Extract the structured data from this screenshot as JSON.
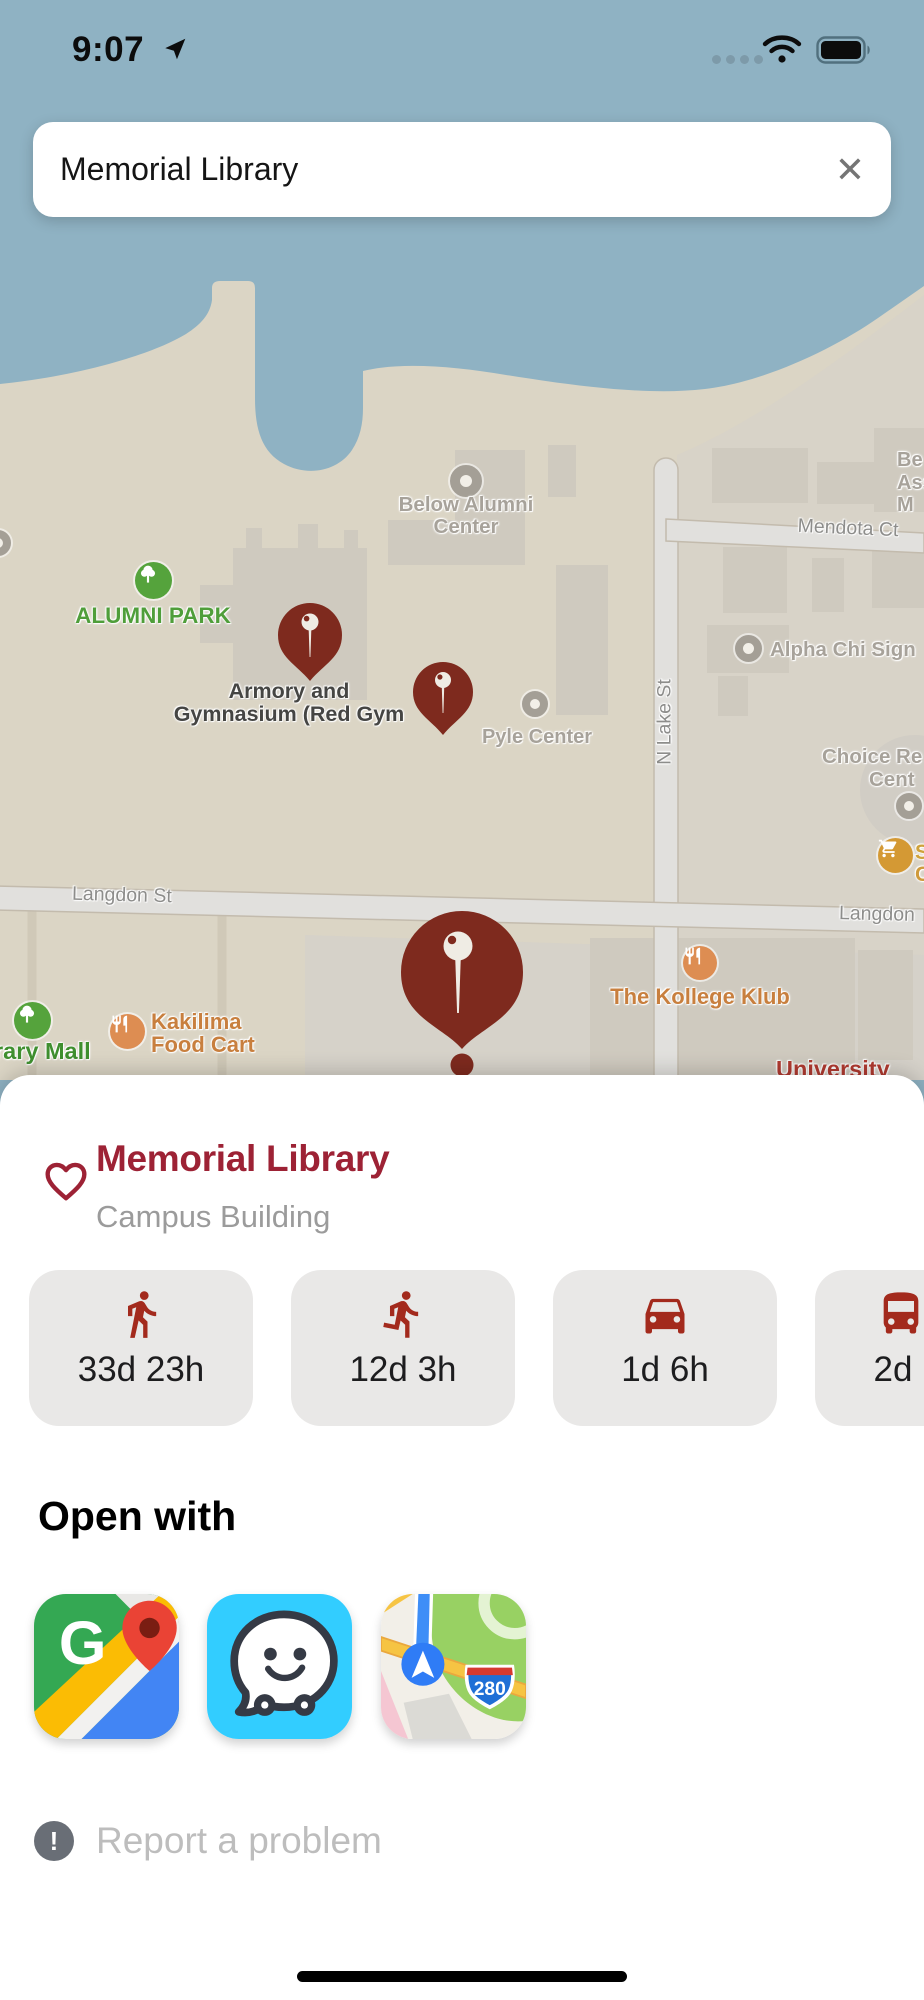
{
  "status_bar": {
    "time": "9:07"
  },
  "search": {
    "query": "Memorial Library",
    "clear_glyph": "✕"
  },
  "map": {
    "poi_labels": {
      "below_alumni_center": "Below Alumni Center",
      "alumni_park": "ALUMNI PARK",
      "armory_line1": "Armory and",
      "armory_line2": "Gymnasium (Red Gym",
      "pyle_center": "Pyle Center",
      "alpha_chi": "Alpha Chi Sign",
      "choice_line1": "Choice Re",
      "choice_line2": "Cent",
      "kollege_klub": "The Kollege Klub",
      "kakilima": "Kakilima Food Cart",
      "library_mall": "rary Mall",
      "university": "University",
      "ne_trunc_1": "Be",
      "ne_trunc_2": "Ass",
      "ne_trunc_3": "M",
      "cart_trunc_1": "S",
      "cart_trunc_2": "C"
    },
    "street_labels": {
      "mendota_ct": "Mendota Ct",
      "n_lake_st": "N Lake St",
      "langdon_st_left": "Langdon St",
      "langdon_st_right": "Langdon"
    }
  },
  "sheet": {
    "title": "Memorial Library",
    "subtitle": "Campus Building",
    "travel_modes": [
      {
        "icon": "walk-icon",
        "label": "33d 23h"
      },
      {
        "icon": "run-icon",
        "label": "12d 3h"
      },
      {
        "icon": "car-icon",
        "label": "1d 6h"
      },
      {
        "icon": "bus-icon",
        "label": "2d"
      }
    ],
    "open_with_heading": "Open with",
    "apps": [
      {
        "name": "Google Maps",
        "icon": "google-maps-icon",
        "letter": "G"
      },
      {
        "name": "Waze",
        "icon": "waze-icon"
      },
      {
        "name": "Apple Maps",
        "icon": "apple-maps-icon",
        "shield_text": "280"
      }
    ],
    "report_glyph": "!",
    "report_label": "Report a problem"
  },
  "colors": {
    "water": "#8fb2c3",
    "land": "#dbd5c5",
    "pin_red": "#7e2a1e",
    "accent_red": "#9d2235",
    "chip_bg": "#e9e8e7",
    "map_green": "#4f9e3a",
    "map_orange": "#c87f3e"
  }
}
